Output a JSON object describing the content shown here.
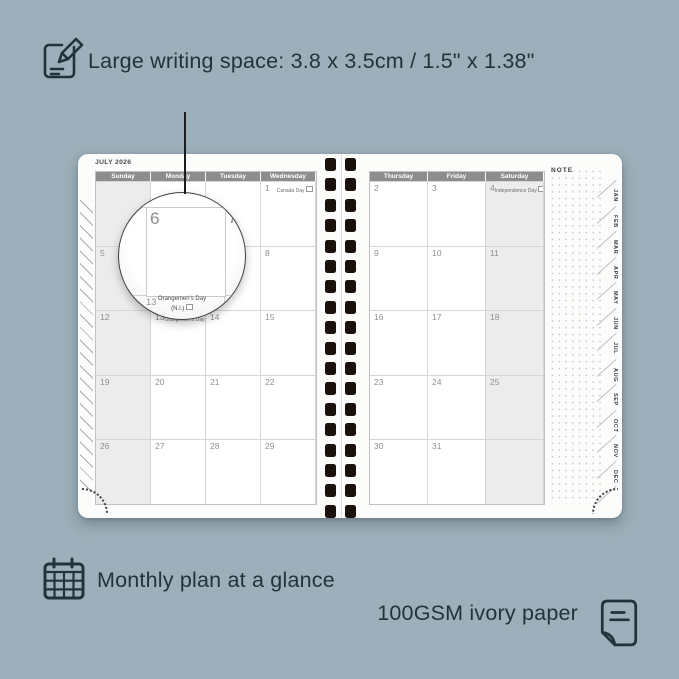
{
  "colors": {
    "background": "#9DAFBA",
    "ink": "#22333E",
    "day_header_bg": "#8D8D8D",
    "weekend_bg": "#ECECEC",
    "grid_line": "#D6D6D6",
    "date_text": "#8F8F8F",
    "binding_hole": "#1A110C",
    "page": "#FCFCFB"
  },
  "icons": {
    "top": "notepad-pencil-icon",
    "bottom_left": "calendar-grid-icon",
    "bottom_right": "paper-sheet-icon",
    "holiday": "flag-icon"
  },
  "annotations": {
    "top_feature": "Large writing space: 3.8 x 3.5cm / 1.5\" x 1.38\"",
    "bottom_feature": "Monthly plan at a glance",
    "paper_feature": "100GSM ivory paper"
  },
  "planner": {
    "month_title": "JULY 2026",
    "note_label": "NOTE",
    "tabs": [
      "JAN",
      "FEB",
      "MAR",
      "APR",
      "MAY",
      "JUN",
      "JUL",
      "AUG",
      "SEP",
      "OCT",
      "NOV",
      "DEC"
    ],
    "left_page": {
      "day_headers": [
        "Sunday",
        "Monday",
        "Tuesday",
        "Wednesday"
      ],
      "weekend_col": 0,
      "rows": [
        [
          {
            "date": ""
          },
          {
            "date": ""
          },
          {
            "date": ""
          },
          {
            "date": "1",
            "holiday": "Canada Day"
          }
        ],
        [
          {
            "date": "5"
          },
          {
            "date": "6"
          },
          {
            "date": "7"
          },
          {
            "date": "8"
          }
        ],
        [
          {
            "date": "12"
          },
          {
            "date": "13",
            "holiday": "Orangemen's Day (N.I.)"
          },
          {
            "date": "14"
          },
          {
            "date": "15"
          }
        ],
        [
          {
            "date": "19"
          },
          {
            "date": "20"
          },
          {
            "date": "21"
          },
          {
            "date": "22"
          }
        ],
        [
          {
            "date": "26"
          },
          {
            "date": "27"
          },
          {
            "date": "28"
          },
          {
            "date": "29"
          }
        ]
      ]
    },
    "right_page": {
      "day_headers": [
        "Thursday",
        "Friday",
        "Saturday"
      ],
      "weekend_col": 2,
      "rows": [
        [
          {
            "date": "2"
          },
          {
            "date": "3"
          },
          {
            "date": "4",
            "holiday": "Independence Day"
          }
        ],
        [
          {
            "date": "9"
          },
          {
            "date": "10"
          },
          {
            "date": "11"
          }
        ],
        [
          {
            "date": "16"
          },
          {
            "date": "17"
          },
          {
            "date": "18"
          }
        ],
        [
          {
            "date": "23"
          },
          {
            "date": "24"
          },
          {
            "date": "25"
          }
        ],
        [
          {
            "date": "30"
          },
          {
            "date": "31"
          },
          {
            "date": ""
          }
        ]
      ]
    },
    "magnifier": {
      "large_date": "6",
      "adjacent_date": "7",
      "below_date": "13",
      "holiday_name": "Orangemen's Day",
      "holiday_region": "(N.I.)"
    }
  }
}
